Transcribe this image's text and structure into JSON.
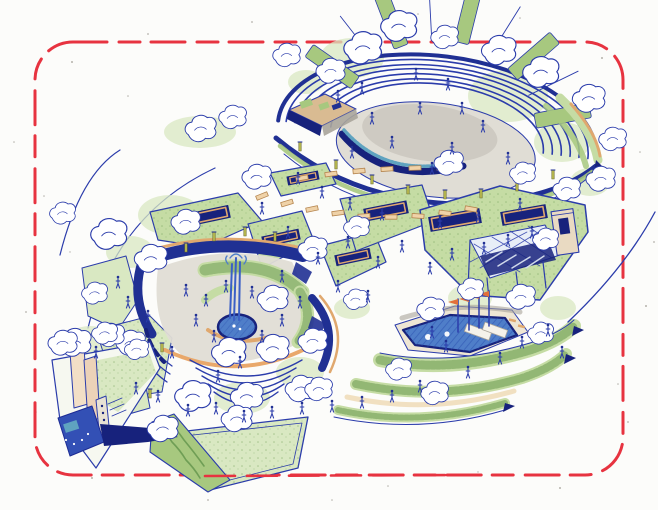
{
  "palette": {
    "ink": "#2b3cab",
    "inkDeep": "#1d2b94",
    "navy": "#203093",
    "navyDeep": "#17227c",
    "water": "#4f7ec9",
    "waterHatch": "#2a4fae",
    "teal": "#5fa3c0",
    "greenLight": "#d9e8c2",
    "green": "#c5dca4",
    "greenMid": "#a7c87f",
    "greenDark": "#6f9e55",
    "olive": "#b9ba4f",
    "tan": "#efd2a8",
    "tanDeep": "#e0a86e",
    "orange": "#e2703a",
    "grayLight": "#e0ddd5",
    "gray": "#c6c2b9",
    "grayDark": "#a9a49a",
    "stage": "#d9bb92",
    "glass": "#e8eef7",
    "red": "#e73340",
    "paper": "#fcfcfa",
    "speckle": "#b4b2ab"
  },
  "border": {
    "style": "dashed",
    "color": "#e73340"
  },
  "scatter": {
    "washes": [
      [
        352,
        58,
        32,
        20
      ],
      [
        306,
        82,
        18,
        12
      ],
      [
        508,
        96,
        40,
        26
      ],
      [
        562,
        142,
        28,
        20
      ],
      [
        590,
        182,
        20,
        14
      ],
      [
        200,
        132,
        36,
        16
      ],
      [
        170,
        215,
        32,
        20
      ],
      [
        130,
        252,
        24,
        16
      ],
      [
        90,
        344,
        26,
        18
      ],
      [
        435,
        162,
        20,
        12
      ],
      [
        470,
        298,
        22,
        14
      ],
      [
        558,
        308,
        18,
        12
      ],
      [
        300,
        372,
        24,
        15
      ],
      [
        242,
        398,
        28,
        16
      ],
      [
        352,
        308,
        18,
        11
      ],
      [
        112,
        288,
        20,
        14
      ]
    ],
    "trees": [
      [
        362,
        52,
        1.1
      ],
      [
        398,
        30,
        1.05
      ],
      [
        330,
        74,
        0.85
      ],
      [
        286,
        58,
        0.8
      ],
      [
        444,
        40,
        0.8
      ],
      [
        498,
        54,
        1.0
      ],
      [
        540,
        76,
        1.05
      ],
      [
        588,
        102,
        0.95
      ],
      [
        612,
        142,
        0.8
      ],
      [
        200,
        132,
        0.9
      ],
      [
        232,
        120,
        0.8
      ],
      [
        108,
        238,
        1.05
      ],
      [
        150,
        262,
        0.95
      ],
      [
        185,
        225,
        0.85
      ],
      [
        62,
        216,
        0.75
      ],
      [
        256,
        180,
        0.85
      ],
      [
        312,
        252,
        0.85
      ],
      [
        356,
        230,
        0.75
      ],
      [
        272,
        302,
        0.9
      ],
      [
        228,
        356,
        1.0
      ],
      [
        272,
        352,
        0.95
      ],
      [
        312,
        344,
        0.85
      ],
      [
        192,
        400,
        1.05
      ],
      [
        246,
        400,
        0.95
      ],
      [
        300,
        392,
        0.9
      ],
      [
        448,
        166,
        0.85
      ],
      [
        522,
        176,
        0.75
      ],
      [
        600,
        182,
        0.85
      ],
      [
        566,
        192,
        0.8
      ],
      [
        545,
        242,
        0.75
      ],
      [
        520,
        300,
        0.85
      ],
      [
        470,
        292,
        0.75
      ],
      [
        430,
        312,
        0.8
      ],
      [
        540,
        336,
        0.75
      ],
      [
        162,
        432,
        0.9
      ],
      [
        236,
        422,
        0.9
      ],
      [
        130,
        346,
        0.85
      ],
      [
        74,
        346,
        0.95
      ],
      [
        110,
        338,
        0.8
      ],
      [
        62,
        346,
        0.85
      ],
      [
        104,
        336,
        0.75
      ],
      [
        136,
        352,
        0.7
      ],
      [
        318,
        392,
        0.8
      ],
      [
        398,
        372,
        0.75
      ],
      [
        434,
        396,
        0.8
      ],
      [
        355,
        302,
        0.7
      ],
      [
        94,
        296,
        0.75
      ]
    ],
    "people": [
      [
        372,
        118
      ],
      [
        392,
        142
      ],
      [
        420,
        108
      ],
      [
        452,
        148
      ],
      [
        483,
        126
      ],
      [
        508,
        158
      ],
      [
        432,
        168
      ],
      [
        352,
        152
      ],
      [
        462,
        108
      ],
      [
        416,
        74
      ],
      [
        448,
        84
      ],
      [
        338,
        96
      ],
      [
        362,
        88
      ],
      [
        298,
        178
      ],
      [
        322,
        192
      ],
      [
        350,
        204
      ],
      [
        382,
        214
      ],
      [
        440,
        222
      ],
      [
        478,
        216
      ],
      [
        520,
        204
      ],
      [
        262,
        208
      ],
      [
        288,
        232
      ],
      [
        318,
        258
      ],
      [
        348,
        242
      ],
      [
        378,
        262
      ],
      [
        402,
        246
      ],
      [
        338,
        286
      ],
      [
        368,
        296
      ],
      [
        300,
        302
      ],
      [
        282,
        276
      ],
      [
        186,
        290
      ],
      [
        206,
        300
      ],
      [
        226,
        286
      ],
      [
        252,
        292
      ],
      [
        214,
        336
      ],
      [
        196,
        320
      ],
      [
        262,
        336
      ],
      [
        282,
        320
      ],
      [
        240,
        362
      ],
      [
        218,
        376
      ],
      [
        172,
        352
      ],
      [
        430,
        268
      ],
      [
        452,
        254
      ],
      [
        484,
        248
      ],
      [
        508,
        240
      ],
      [
        532,
        232
      ],
      [
        432,
        332
      ],
      [
        446,
        346
      ],
      [
        500,
        358
      ],
      [
        522,
        342
      ],
      [
        468,
        372
      ],
      [
        420,
        386
      ],
      [
        392,
        396
      ],
      [
        362,
        402
      ],
      [
        332,
        406
      ],
      [
        302,
        408
      ],
      [
        272,
        412
      ],
      [
        244,
        416
      ],
      [
        216,
        408
      ],
      [
        188,
        410
      ],
      [
        158,
        396
      ],
      [
        136,
        388
      ],
      [
        128,
        302
      ],
      [
        148,
        316
      ],
      [
        118,
        282
      ],
      [
        96,
        352
      ],
      [
        548,
        330
      ],
      [
        562,
        352
      ]
    ],
    "posts": [
      [
        300,
        151
      ],
      [
        336,
        169
      ],
      [
        372,
        184
      ],
      [
        408,
        194
      ],
      [
        445,
        199
      ],
      [
        481,
        198
      ],
      [
        517,
        191
      ],
      [
        553,
        179
      ],
      [
        186,
        252
      ],
      [
        214,
        241
      ],
      [
        245,
        236
      ],
      [
        275,
        241
      ],
      [
        305,
        253
      ],
      [
        162,
        352
      ],
      [
        150,
        398
      ]
    ],
    "benches": [
      [
        262,
        196,
        -22
      ],
      [
        287,
        203,
        -17
      ],
      [
        312,
        209,
        -12
      ],
      [
        338,
        213,
        -8
      ],
      [
        364,
        216,
        -4
      ],
      [
        391,
        217,
        0
      ],
      [
        418,
        216,
        4
      ],
      [
        445,
        213,
        7
      ],
      [
        471,
        209,
        10
      ],
      [
        302,
        178,
        -10
      ],
      [
        331,
        174,
        -8
      ],
      [
        359,
        171,
        -6
      ],
      [
        387,
        169,
        -4
      ],
      [
        415,
        168,
        -2
      ],
      [
        443,
        168,
        0
      ]
    ],
    "speckles": [
      [
        72,
        62,
        1
      ],
      [
        128,
        96,
        0.8
      ],
      [
        252,
        22,
        0.9
      ],
      [
        418,
        14,
        0.8
      ],
      [
        602,
        58,
        1
      ],
      [
        640,
        152,
        0.8
      ],
      [
        646,
        306,
        1
      ],
      [
        628,
        422,
        0.9
      ],
      [
        560,
        488,
        1
      ],
      [
        332,
        500,
        0.8
      ],
      [
        208,
        500,
        0.9
      ],
      [
        92,
        478,
        1
      ],
      [
        36,
        412,
        0.8
      ],
      [
        26,
        312,
        0.9
      ],
      [
        44,
        196,
        0.8
      ],
      [
        148,
        34,
        0.9
      ],
      [
        520,
        18,
        0.8
      ],
      [
        654,
        242,
        0.9
      ],
      [
        14,
        142,
        0.8
      ],
      [
        582,
        120,
        0.7
      ],
      [
        618,
        384,
        0.8
      ],
      [
        70,
        252,
        0.7
      ],
      [
        388,
        486,
        0.8
      ],
      [
        478,
        472,
        0.7
      ],
      [
        35,
        95,
        0.8
      ]
    ]
  }
}
